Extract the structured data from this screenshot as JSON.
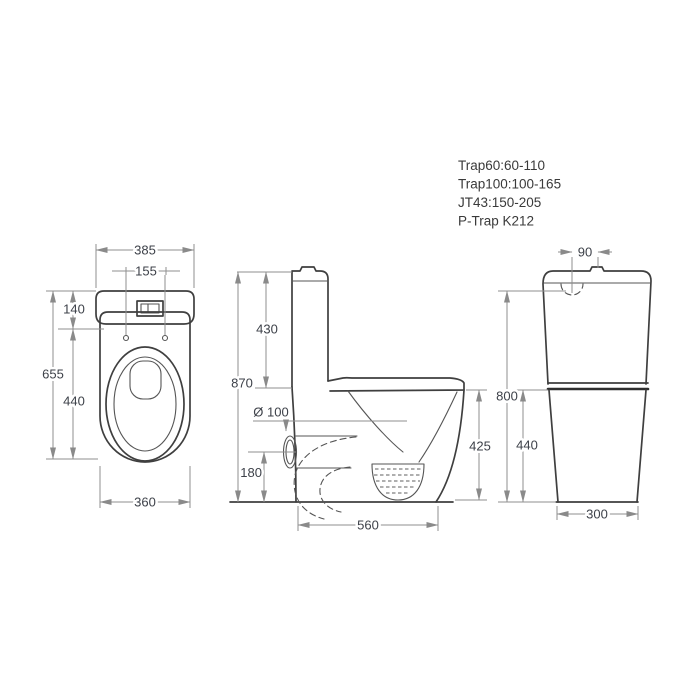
{
  "notes": {
    "trap60": "Trap60:60-110",
    "trap100": "Trap100:100-165",
    "jt43": "JT43:150-205",
    "ptrap": "P-Trap K212"
  },
  "plan_view": {
    "tank_width": "385",
    "hinge_spacing": "155",
    "tank_depth": "140",
    "overall_depth": "655",
    "bowl_length": "440",
    "base_width": "360"
  },
  "side_view": {
    "tank_height": "430",
    "overall_height": "870",
    "outlet_diameter": "Ø 100",
    "outlet_height": "180",
    "overall_depth": "560",
    "seat_height": "425"
  },
  "rear_view": {
    "button_width": "90",
    "lid_height": "800",
    "seat_height": "440",
    "base_width": "300"
  },
  "colors": {
    "line": "#3f3f3f",
    "dimension": "#8f8f8f",
    "background": "#ffffff"
  }
}
